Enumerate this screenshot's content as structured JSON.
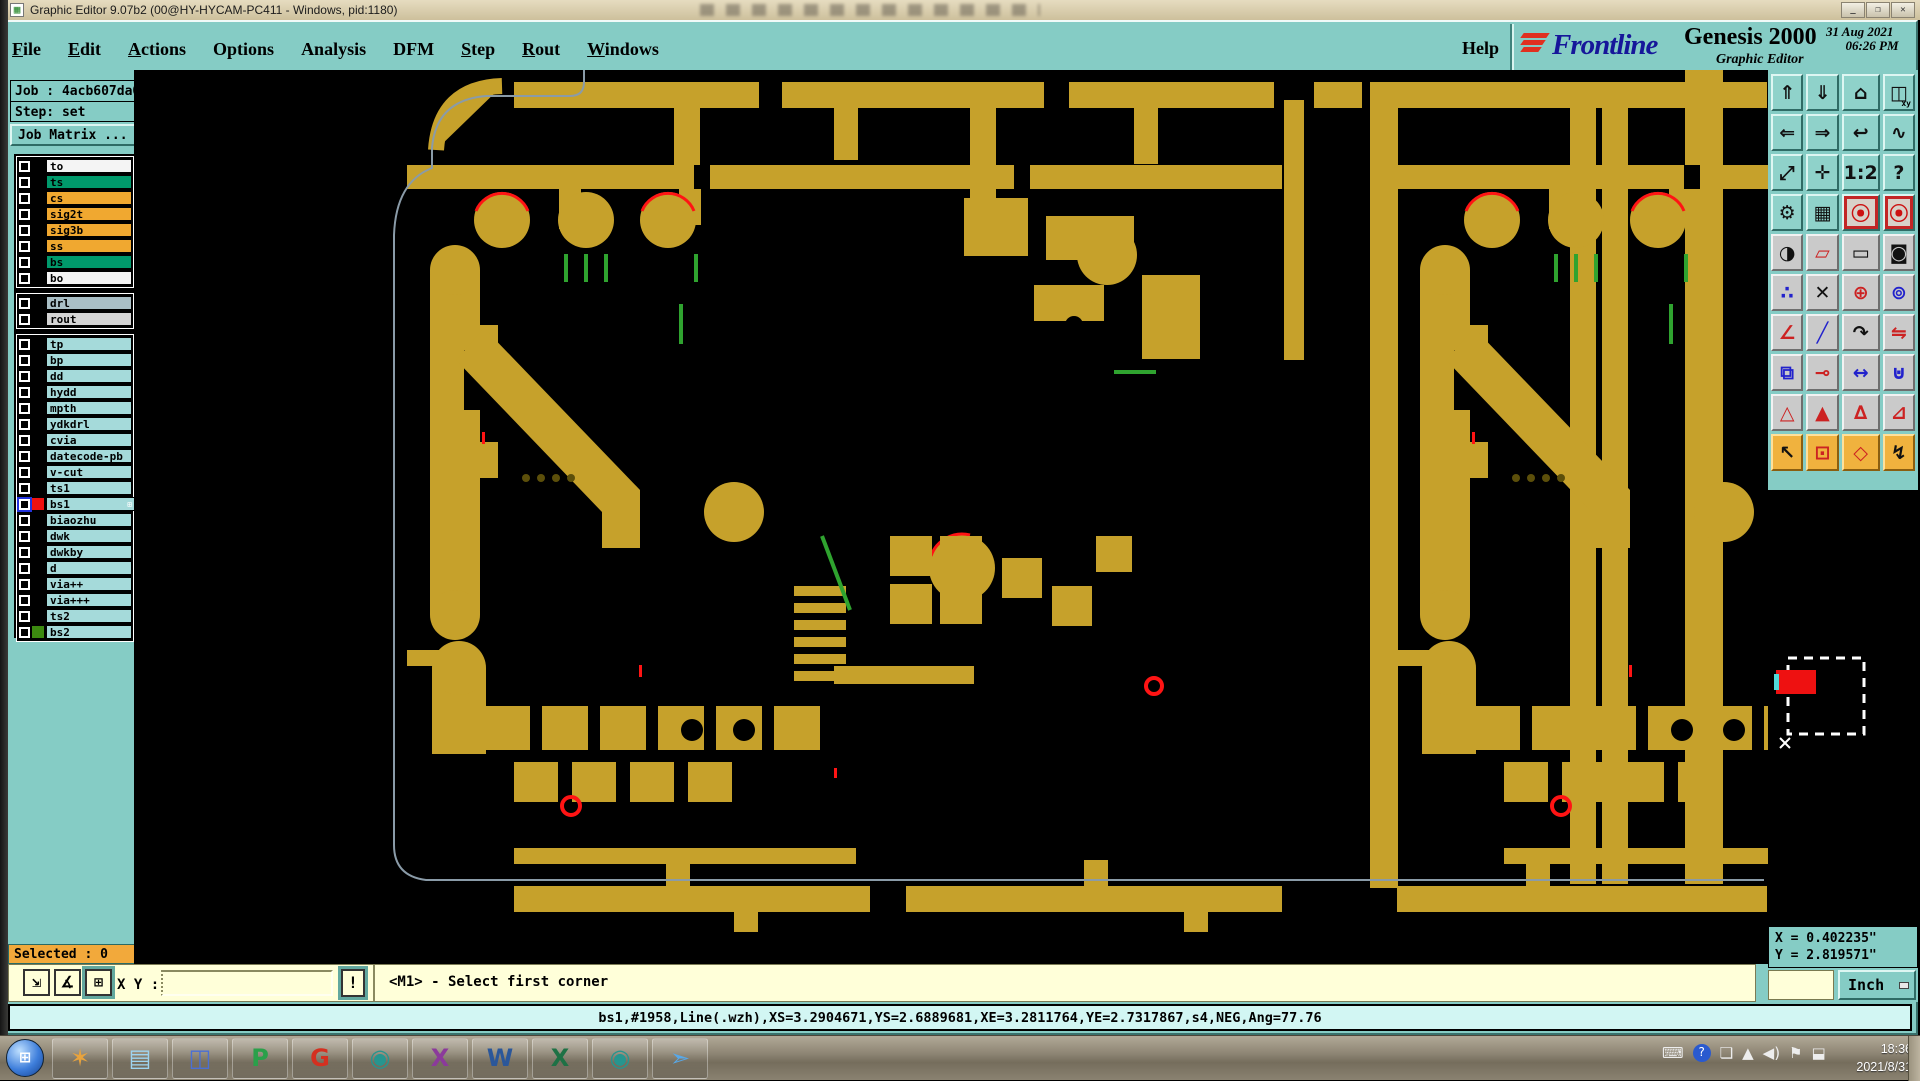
{
  "colors": {
    "copper": "#C6A12B",
    "pcbgreen": "#2FA32F",
    "pcbred": "#FF1414",
    "outline": "#8A9BA8",
    "teal": "#85CCC5",
    "cream": "#FFFFD9",
    "orange": "#F2A93B",
    "cyanbar": "#D2F6F3"
  },
  "title_bar": {
    "icon_glyph": "▦",
    "title": "Graphic Editor 9.07b2 (00@HY-HYCAM-PC411 - Windows, pid:1180)",
    "window_buttons": [
      {
        "name": "minimize-button",
        "glyph": "_"
      },
      {
        "name": "maximize-button",
        "glyph": "❐"
      },
      {
        "name": "close-button",
        "glyph": "✕"
      }
    ]
  },
  "menu": {
    "items": [
      {
        "label": "File",
        "ul": true
      },
      {
        "label": "Edit",
        "ul": true
      },
      {
        "label": "Actions",
        "ul": true
      },
      {
        "label": "Options",
        "ul": false
      },
      {
        "label": "Analysis",
        "ul": false
      },
      {
        "label": "DFM",
        "ul": false
      },
      {
        "label": "Step",
        "ul": true
      },
      {
        "label": "Rout",
        "ul": true
      },
      {
        "label": "Windows",
        "ul": true
      }
    ],
    "help": "Help"
  },
  "brand": {
    "logo_text": "Frontline",
    "product": "Genesis 2000",
    "date": "31 Aug 2021",
    "time": "06:26 PM",
    "subtitle": "Graphic Editor"
  },
  "sidebar": {
    "job_label": "Job : 4acb607da0",
    "step_label": "Step: set",
    "job_matrix_button": "Job Matrix ...",
    "selected_label": "Selected : 0",
    "layer_groups": [
      {
        "rows": [
          {
            "name": "to",
            "bg": "white"
          },
          {
            "name": "ts",
            "bg": "green"
          },
          {
            "name": "cs",
            "bg": "orange"
          },
          {
            "name": "sig2t",
            "bg": "orange"
          },
          {
            "name": "sig3b",
            "bg": "orange"
          },
          {
            "name": "ss",
            "bg": "orange"
          },
          {
            "name": "bs",
            "bg": "green"
          },
          {
            "name": "bo",
            "bg": "white"
          }
        ]
      },
      {
        "rows": [
          {
            "name": "drl",
            "bg": "drl"
          },
          {
            "name": "rout",
            "bg": "rout"
          }
        ]
      },
      {
        "rows": [
          {
            "name": "tp",
            "bg": "cyan"
          },
          {
            "name": "bp",
            "bg": "cyan"
          },
          {
            "name": "dd",
            "bg": "cyan"
          },
          {
            "name": "hydd",
            "bg": "cyan"
          },
          {
            "name": "mpth",
            "bg": "cyan"
          },
          {
            "name": "ydkdrl",
            "bg": "cyan"
          },
          {
            "name": "cvia",
            "bg": "cyan"
          },
          {
            "name": "datecode-pb",
            "bg": "cyan"
          },
          {
            "name": "v-cut",
            "bg": "cyan"
          },
          {
            "name": "ts1",
            "bg": "cyan"
          },
          {
            "name": "bs1",
            "bg": "cyan",
            "active": true,
            "swatch": "#EE1111",
            "badge": "⊞"
          },
          {
            "name": "biaozhu",
            "bg": "cyan"
          },
          {
            "name": "dwk",
            "bg": "cyan"
          },
          {
            "name": "dwkby",
            "bg": "cyan"
          },
          {
            "name": "d",
            "bg": "cyan"
          },
          {
            "name": "via++",
            "bg": "cyan"
          },
          {
            "name": "via+++",
            "bg": "cyan"
          },
          {
            "name": "ts2",
            "bg": "cyan"
          },
          {
            "name": "bs2",
            "bg": "cyan",
            "swatch": "#3C8A10"
          }
        ]
      }
    ]
  },
  "toolbar": {
    "rows": [
      {
        "style": "teal",
        "buttons": [
          {
            "name": "box-arrow-up",
            "glyph": "⇑"
          },
          {
            "name": "box-arrow-down",
            "glyph": "⇓"
          },
          {
            "name": "home-view",
            "glyph": "⌂"
          },
          {
            "name": "window-xy",
            "glyph": "◫",
            "sub": "xy"
          }
        ]
      },
      {
        "style": "teal",
        "buttons": [
          {
            "name": "box-arrow-left",
            "glyph": "⇐"
          },
          {
            "name": "box-arrow-right",
            "glyph": "⇒"
          },
          {
            "name": "previous-view",
            "glyph": "↩"
          },
          {
            "name": "serpentine-route",
            "glyph": "∿"
          }
        ]
      },
      {
        "style": "teal",
        "buttons": [
          {
            "name": "zoom-out-fit",
            "glyph": "⤢"
          },
          {
            "name": "zoom-center",
            "glyph": "✛"
          },
          {
            "name": "scale-1-2",
            "glyph": "1:2"
          },
          {
            "name": "context-help",
            "glyph": "?"
          }
        ]
      },
      {
        "style": "teal",
        "buttons": [
          {
            "name": "toolbox",
            "glyph": "⚙"
          },
          {
            "name": "grid-display",
            "glyph": "▦"
          },
          {
            "name": "signal-layers-a",
            "glyph": "⦿",
            "frame": "red",
            "color": "#CC1111"
          },
          {
            "name": "signal-layers-b",
            "glyph": "⦿",
            "frame": "red",
            "color": "#CC1111"
          }
        ]
      },
      {
        "style": "gray",
        "buttons": [
          {
            "name": "highlight-symbol",
            "glyph": "◑"
          },
          {
            "name": "reshape-pad",
            "glyph": "▱",
            "color": "#CC2222"
          },
          {
            "name": "measure-ruler",
            "glyph": "▭"
          },
          {
            "name": "select-pad",
            "glyph": "◙"
          }
        ]
      },
      {
        "style": "gray",
        "buttons": [
          {
            "name": "net-markup",
            "glyph": "∴",
            "color": "#2222CC"
          },
          {
            "name": "delete-cross",
            "glyph": "✕"
          },
          {
            "name": "grow-symbol",
            "glyph": "⊕",
            "color": "#CC2222"
          },
          {
            "name": "move-symbol",
            "glyph": "⊚",
            "color": "#2222CC"
          }
        ]
      },
      {
        "style": "gray",
        "buttons": [
          {
            "name": "angle-tool",
            "glyph": "∠",
            "color": "#CC2222"
          },
          {
            "name": "slope-tool",
            "glyph": "╱",
            "color": "#2222CC"
          },
          {
            "name": "rotate-tool",
            "glyph": "↷"
          },
          {
            "name": "mirror-tool",
            "glyph": "⇋",
            "color": "#CC2222"
          }
        ]
      },
      {
        "style": "gray",
        "buttons": [
          {
            "name": "copy-pad",
            "glyph": "⧉",
            "color": "#2222CC"
          },
          {
            "name": "stretch-segment",
            "glyph": "⊸",
            "color": "#CC2222"
          },
          {
            "name": "dimension-tool",
            "glyph": "↔",
            "color": "#2222CC"
          },
          {
            "name": "merge-shapes",
            "glyph": "⊍",
            "color": "#2222CC"
          }
        ]
      },
      {
        "style": "gray",
        "buttons": [
          {
            "name": "arc-fill-a",
            "glyph": "△",
            "color": "#CC2222"
          },
          {
            "name": "arc-fill-b",
            "glyph": "▲",
            "color": "#CC2222"
          },
          {
            "name": "arc-fill-c",
            "glyph": "∆",
            "color": "#CC2222"
          },
          {
            "name": "arc-fill-d",
            "glyph": "⊿",
            "color": "#CC2222"
          }
        ]
      },
      {
        "style": "orange",
        "buttons": [
          {
            "name": "select-cursor",
            "glyph": "↖"
          },
          {
            "name": "select-window",
            "glyph": "⊡",
            "color": "#CC2222"
          },
          {
            "name": "select-polygon",
            "glyph": "◇",
            "color": "#CC2222"
          },
          {
            "name": "select-route",
            "glyph": "↯"
          }
        ]
      }
    ]
  },
  "readout": {
    "x": "X = 0.402235\"",
    "y": "Y = 2.819571\"",
    "units": "Inch"
  },
  "command_bar": {
    "tools": [
      {
        "name": "zoom-window",
        "glyph": "⇲"
      },
      {
        "name": "angle-measure",
        "glyph": "∡"
      },
      {
        "name": "grid-lock",
        "glyph": "⊞",
        "selected": true
      }
    ],
    "xy_label": "X Y :",
    "input_value": "",
    "confirm_glyph": "!",
    "prompt": "<M1> - Select first corner"
  },
  "status_bar": {
    "text": "bs1,#1958,Line(.wzh),XS=3.2904671,YS=2.6889681,XE=3.2811764,YE=2.7317867,s4,NEG,Ang=77.76"
  },
  "taskbar": {
    "start_glyph": "⊞",
    "icons": [
      {
        "name": "shell",
        "glyph": "✶",
        "color": "#E8A33D"
      },
      {
        "name": "notepad",
        "glyph": "▤",
        "color": "#9ED4F0"
      },
      {
        "name": "floppy-save",
        "glyph": "◫",
        "color": "#4A6FD4"
      },
      {
        "name": "flexlm-p",
        "glyph": "P",
        "color": "#2AA04A"
      },
      {
        "name": "genesis-g",
        "glyph": "G",
        "color": "#D43020"
      },
      {
        "name": "cam-viewer",
        "glyph": "◉",
        "color": "#27958F"
      },
      {
        "name": "exceed-x",
        "glyph": "X",
        "color": "#8B3A9B"
      },
      {
        "name": "word",
        "glyph": "W",
        "color": "#2B579A"
      },
      {
        "name": "excel",
        "glyph": "X",
        "color": "#1E7145"
      },
      {
        "name": "cam-viewer-2",
        "glyph": "◉",
        "color": "#27958F"
      },
      {
        "name": "messenger",
        "glyph": "➣",
        "color": "#58A8E8"
      }
    ],
    "tray_icons": [
      {
        "name": "keyboard",
        "glyph": "⌨"
      },
      {
        "name": "help-bubble",
        "glyph": "?",
        "cls": "ti-help"
      },
      {
        "name": "window-stack",
        "glyph": "❏"
      },
      {
        "name": "show-hidden",
        "glyph": "▲"
      },
      {
        "name": "volume",
        "glyph": "◀)"
      },
      {
        "name": "action-flag",
        "glyph": "⚑"
      },
      {
        "name": "network",
        "glyph": "⬓"
      }
    ],
    "clock_time": "18:36",
    "clock_date": "2021/8/31"
  }
}
